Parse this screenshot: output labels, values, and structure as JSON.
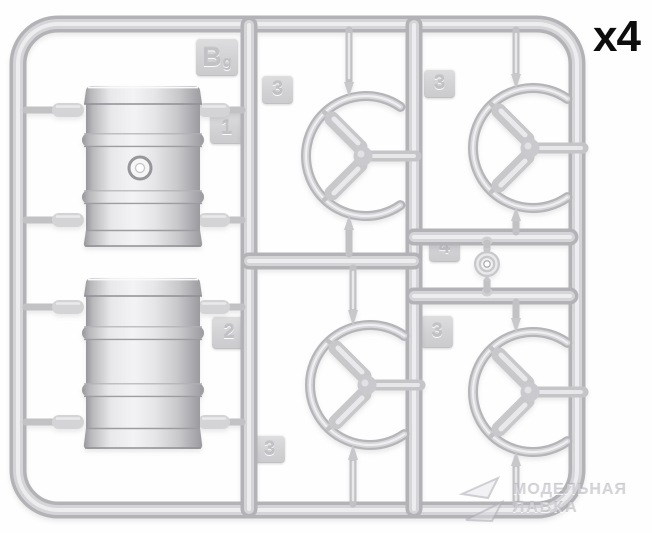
{
  "annotation": {
    "quantity": "x4"
  },
  "sprue": {
    "label_main": "B",
    "label_sub": "g",
    "tabs": [
      {
        "id": "fuel-drum-top",
        "label": "1"
      },
      {
        "id": "fuel-drum-bottom",
        "label": "2"
      },
      {
        "id": "ring-top-middle",
        "label": "3"
      },
      {
        "id": "ring-top-right",
        "label": "3"
      },
      {
        "id": "small-disc",
        "label": "4"
      },
      {
        "id": "ring-bottom-right",
        "label": "3"
      },
      {
        "id": "ring-bottom-middle",
        "label": "3"
      }
    ]
  },
  "watermark": {
    "line1": "МОДЕЛЬНАЯ",
    "line2": "ЛАВКА"
  },
  "colors": {
    "background": "#ffffff",
    "plastic_base": "#c9c9cd",
    "plastic_mid": "#dadadd",
    "plastic_highlight": "#f0f0f2",
    "plastic_shadow": "#a7a7ab",
    "annotation_text": "#0d0d0d",
    "watermark_text": "#b2b2ba"
  }
}
